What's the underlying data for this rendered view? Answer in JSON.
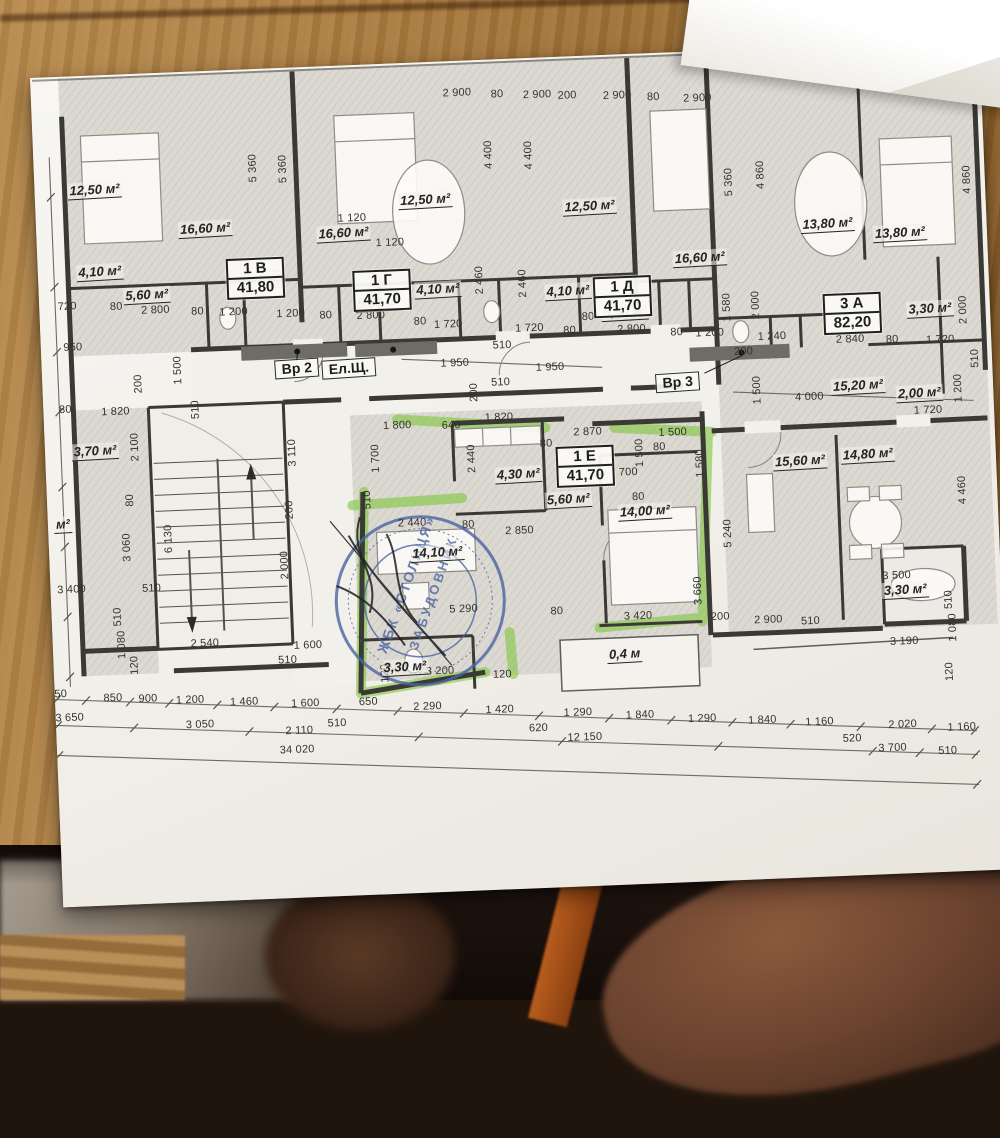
{
  "photo": {
    "scene": "floor plan sheet on wooden desk",
    "wood_color": "#aa7c41",
    "paper_color": "#f4f3ef",
    "shadow_color": "#120b07",
    "ink_color": "#34322d"
  },
  "plan": {
    "highlight_color": "#7fc63e",
    "stamp": {
      "line1": "ЖБК «СТОЛИЦЯ»",
      "line2": "ЗАБУДОВНИК",
      "color": "#4b63a5"
    },
    "units": [
      {
        "id": "1 В",
        "area": "41,80",
        "x": 217,
        "y": 209
      },
      {
        "id": "1 Г",
        "area": "41,70",
        "x": 343,
        "y": 226
      },
      {
        "id": "1 Д",
        "area": "41,70",
        "x": 583,
        "y": 242
      },
      {
        "id": "3 А",
        "area": "82,20",
        "x": 812,
        "y": 268
      },
      {
        "id": "1 Е",
        "area": "41,70",
        "x": 539,
        "y": 410
      }
    ],
    "doors": [
      {
        "t": "Вр 2",
        "x": 255,
        "y": 301
      },
      {
        "t": "Ел.Щ.",
        "x": 307,
        "y": 303
      },
      {
        "t": "Вр 3",
        "x": 635,
        "y": 330
      }
    ],
    "rooms": [
      {
        "t": "12,50 м²",
        "x": 60,
        "y": 115
      },
      {
        "t": "16,60 м²",
        "x": 169,
        "y": 158
      },
      {
        "t": "16,60 м²",
        "x": 307,
        "y": 168
      },
      {
        "t": "12,50 м²",
        "x": 390,
        "y": 138
      },
      {
        "t": "12,50 м²",
        "x": 554,
        "y": 151
      },
      {
        "t": "16,60 м²",
        "x": 662,
        "y": 207
      },
      {
        "t": "13,80 м²",
        "x": 791,
        "y": 178
      },
      {
        "t": "13,80 м²",
        "x": 863,
        "y": 190
      },
      {
        "t": "4,10 м²",
        "x": 62,
        "y": 197
      },
      {
        "t": "4,10 м²",
        "x": 399,
        "y": 228
      },
      {
        "t": "4,10 м²",
        "x": 529,
        "y": 235
      },
      {
        "t": "5,60 м²",
        "x": 108,
        "y": 222
      },
      {
        "t": "5,50 м²",
        "x": 339,
        "y": 239
      },
      {
        "t": "5,50 м²",
        "x": 585,
        "y": 258
      },
      {
        "t": "3,30 м²",
        "x": 890,
        "y": 267
      },
      {
        "t": "15,20 м²",
        "x": 815,
        "y": 341
      },
      {
        "t": "2,00 м²",
        "x": 876,
        "y": 351
      },
      {
        "t": "3,70 м²",
        "x": 50,
        "y": 376
      },
      {
        "t": "4,30 м²",
        "x": 472,
        "y": 416
      },
      {
        "t": "5,60 м²",
        "x": 521,
        "y": 443
      },
      {
        "t": "14,00 м²",
        "x": 597,
        "y": 458
      },
      {
        "t": "15,60 м²",
        "x": 754,
        "y": 414
      },
      {
        "t": "14,80 м²",
        "x": 822,
        "y": 410
      },
      {
        "t": "14,10 м²",
        "x": 388,
        "y": 491
      },
      {
        "t": "3,30 м²",
        "x": 351,
        "y": 604
      },
      {
        "t": "3,30 м²",
        "x": 854,
        "y": 547
      },
      {
        "t": "0,4 м",
        "x": 571,
        "y": 600
      },
      {
        "t": "м²",
        "x": 15,
        "y": 448
      }
    ],
    "dims": [
      {
        "t": "2 900",
        "x": 426,
        "y": 32
      },
      {
        "t": "80",
        "x": 466,
        "y": 35
      },
      {
        "t": "2 900",
        "x": 506,
        "y": 37
      },
      {
        "t": "200",
        "x": 536,
        "y": 39
      },
      {
        "t": "2 900",
        "x": 586,
        "y": 41
      },
      {
        "t": "80",
        "x": 622,
        "y": 44
      },
      {
        "t": "2 900",
        "x": 666,
        "y": 47
      },
      {
        "t": "5 360",
        "x": 219,
        "y": 99,
        "v": 1
      },
      {
        "t": "5 360",
        "x": 249,
        "y": 101,
        "v": 1
      },
      {
        "t": "4 400",
        "x": 455,
        "y": 95,
        "v": 1
      },
      {
        "t": "4 400",
        "x": 495,
        "y": 97,
        "v": 1
      },
      {
        "t": "5 360",
        "x": 694,
        "y": 132,
        "v": 1
      },
      {
        "t": "4 860",
        "x": 726,
        "y": 126,
        "v": 1
      },
      {
        "t": "4 860",
        "x": 932,
        "y": 139,
        "v": 1
      },
      {
        "t": "1 120",
        "x": 316,
        "y": 153
      },
      {
        "t": "1 120",
        "x": 353,
        "y": 179
      },
      {
        "t": "720",
        "x": 28,
        "y": 230
      },
      {
        "t": "80",
        "x": 77,
        "y": 232
      },
      {
        "t": "2 800",
        "x": 116,
        "y": 237
      },
      {
        "t": "80",
        "x": 158,
        "y": 240
      },
      {
        "t": "1 200",
        "x": 194,
        "y": 242
      },
      {
        "t": "1 580",
        "x": 210,
        "y": 214,
        "v": 1
      },
      {
        "t": "1 580",
        "x": 240,
        "y": 216,
        "v": 1
      },
      {
        "t": "1 200",
        "x": 251,
        "y": 246
      },
      {
        "t": "80",
        "x": 286,
        "y": 249
      },
      {
        "t": "2 800",
        "x": 331,
        "y": 251
      },
      {
        "t": "80",
        "x": 380,
        "y": 259
      },
      {
        "t": "1 720",
        "x": 408,
        "y": 263
      },
      {
        "t": "2 460",
        "x": 441,
        "y": 220,
        "v": 1
      },
      {
        "t": "2 460",
        "x": 484,
        "y": 225,
        "v": 1
      },
      {
        "t": "1 720",
        "x": 489,
        "y": 270
      },
      {
        "t": "80",
        "x": 529,
        "y": 274
      },
      {
        "t": "80",
        "x": 548,
        "y": 261
      },
      {
        "t": "2 800",
        "x": 591,
        "y": 275
      },
      {
        "t": "80",
        "x": 636,
        "y": 280
      },
      {
        "t": "1 200",
        "x": 669,
        "y": 282
      },
      {
        "t": "1 580",
        "x": 687,
        "y": 257,
        "v": 1
      },
      {
        "t": "2 000",
        "x": 716,
        "y": 256,
        "v": 1
      },
      {
        "t": "1 240",
        "x": 731,
        "y": 288
      },
      {
        "t": "2 840",
        "x": 809,
        "y": 294
      },
      {
        "t": "200",
        "x": 702,
        "y": 302
      },
      {
        "t": "80",
        "x": 851,
        "y": 296
      },
      {
        "t": "1 720",
        "x": 899,
        "y": 298
      },
      {
        "t": "2 000",
        "x": 923,
        "y": 269,
        "v": 1
      },
      {
        "t": "510",
        "x": 933,
        "y": 318,
        "v": 1
      },
      {
        "t": "1 200",
        "x": 915,
        "y": 347,
        "v": 1
      },
      {
        "t": "1 720",
        "x": 884,
        "y": 368
      },
      {
        "t": "4 000",
        "x": 766,
        "y": 350
      },
      {
        "t": "1 500",
        "x": 714,
        "y": 341,
        "v": 1
      },
      {
        "t": "4 460",
        "x": 915,
        "y": 449,
        "v": 1
      },
      {
        "t": "950",
        "x": 32,
        "y": 271
      },
      {
        "t": "1 500",
        "x": 136,
        "y": 298,
        "v": 1
      },
      {
        "t": "200",
        "x": 96,
        "y": 310,
        "v": 1
      },
      {
        "t": "80",
        "x": 22,
        "y": 333
      },
      {
        "t": "1 820",
        "x": 72,
        "y": 337
      },
      {
        "t": "510",
        "x": 152,
        "y": 338,
        "v": 1
      },
      {
        "t": "2 100",
        "x": 90,
        "y": 373,
        "v": 1
      },
      {
        "t": "510",
        "x": 461,
        "y": 286
      },
      {
        "t": "1 950",
        "x": 413,
        "y": 302
      },
      {
        "t": "1 950",
        "x": 508,
        "y": 310
      },
      {
        "t": "510",
        "x": 458,
        "y": 323
      },
      {
        "t": "200",
        "x": 431,
        "y": 332,
        "v": 1
      },
      {
        "t": "1 800",
        "x": 353,
        "y": 362
      },
      {
        "t": "640",
        "x": 407,
        "y": 364
      },
      {
        "t": "1 820",
        "x": 455,
        "y": 358
      },
      {
        "t": "2 870",
        "x": 543,
        "y": 376
      },
      {
        "t": "1 500",
        "x": 628,
        "y": 380
      },
      {
        "t": "1 700",
        "x": 330,
        "y": 394,
        "v": 1
      },
      {
        "t": "2 440",
        "x": 426,
        "y": 398,
        "v": 1
      },
      {
        "t": "80",
        "x": 501,
        "y": 386
      },
      {
        "t": "700",
        "x": 582,
        "y": 418
      },
      {
        "t": "1 500",
        "x": 594,
        "y": 399,
        "v": 1
      },
      {
        "t": "80",
        "x": 614,
        "y": 394
      },
      {
        "t": "1 580",
        "x": 654,
        "y": 412,
        "v": 1
      },
      {
        "t": "80",
        "x": 591,
        "y": 443
      },
      {
        "t": "2 440",
        "x": 364,
        "y": 460
      },
      {
        "t": "80",
        "x": 420,
        "y": 464
      },
      {
        "t": "2 850",
        "x": 471,
        "y": 472
      },
      {
        "t": "5 240",
        "x": 679,
        "y": 483,
        "v": 1
      },
      {
        "t": "3 660",
        "x": 647,
        "y": 539,
        "v": 1
      },
      {
        "t": "510",
        "x": 320,
        "y": 435,
        "v": 1
      },
      {
        "t": "5 290",
        "x": 412,
        "y": 548
      },
      {
        "t": "80",
        "x": 505,
        "y": 554
      },
      {
        "t": "3 200",
        "x": 386,
        "y": 609
      },
      {
        "t": "120",
        "x": 448,
        "y": 615
      },
      {
        "t": "120",
        "x": 331,
        "y": 609,
        "v": 1
      },
      {
        "t": "3 420",
        "x": 586,
        "y": 562
      },
      {
        "t": "200",
        "x": 668,
        "y": 566
      },
      {
        "t": "2 900",
        "x": 716,
        "y": 571
      },
      {
        "t": "510",
        "x": 758,
        "y": 574
      },
      {
        "t": "3 500",
        "x": 846,
        "y": 532
      },
      {
        "t": "3 190",
        "x": 851,
        "y": 598
      },
      {
        "t": "510",
        "x": 897,
        "y": 558,
        "v": 1
      },
      {
        "t": "1 080",
        "x": 900,
        "y": 586,
        "v": 1
      },
      {
        "t": "120",
        "x": 895,
        "y": 630,
        "v": 1
      },
      {
        "t": "3 400",
        "x": 21,
        "y": 513
      },
      {
        "t": "510",
        "x": 101,
        "y": 515
      },
      {
        "t": "510",
        "x": 66,
        "y": 542,
        "v": 1
      },
      {
        "t": "1 080",
        "x": 69,
        "y": 570,
        "v": 1
      },
      {
        "t": "120",
        "x": 81,
        "y": 591,
        "v": 1
      },
      {
        "t": "2 540",
        "x": 152,
        "y": 572
      },
      {
        "t": "1 600",
        "x": 255,
        "y": 578
      },
      {
        "t": "510",
        "x": 234,
        "y": 592
      },
      {
        "t": "2 000",
        "x": 235,
        "y": 497,
        "v": 1
      },
      {
        "t": "3 110",
        "x": 247,
        "y": 385,
        "v": 1
      },
      {
        "t": "200",
        "x": 242,
        "y": 442,
        "v": 1
      },
      {
        "t": "6 130",
        "x": 120,
        "y": 466,
        "v": 1
      },
      {
        "t": "80",
        "x": 83,
        "y": 426,
        "v": 1
      },
      {
        "t": "3 060",
        "x": 78,
        "y": 473,
        "v": 1
      },
      {
        "t": "50",
        "x": 6,
        "y": 617
      },
      {
        "t": "850",
        "x": 58,
        "y": 623
      },
      {
        "t": "900",
        "x": 93,
        "y": 625
      },
      {
        "t": "1 200",
        "x": 135,
        "y": 628
      },
      {
        "t": "1 460",
        "x": 189,
        "y": 632
      },
      {
        "t": "1 600",
        "x": 250,
        "y": 636
      },
      {
        "t": "650",
        "x": 313,
        "y": 637
      },
      {
        "t": "2 290",
        "x": 372,
        "y": 644
      },
      {
        "t": "1 420",
        "x": 444,
        "y": 650
      },
      {
        "t": "1 290",
        "x": 522,
        "y": 656
      },
      {
        "t": "1 840",
        "x": 584,
        "y": 661
      },
      {
        "t": "1 290",
        "x": 646,
        "y": 667
      },
      {
        "t": "1 840",
        "x": 706,
        "y": 671
      },
      {
        "t": "1 160",
        "x": 763,
        "y": 675
      },
      {
        "t": "2 020",
        "x": 846,
        "y": 681
      },
      {
        "t": "1 160",
        "x": 905,
        "y": 686
      },
      {
        "t": "3 650",
        "x": 14,
        "y": 641
      },
      {
        "t": "3 050",
        "x": 144,
        "y": 653
      },
      {
        "t": "2 110",
        "x": 243,
        "y": 663
      },
      {
        "t": "510",
        "x": 281,
        "y": 657
      },
      {
        "t": "620",
        "x": 482,
        "y": 670
      },
      {
        "t": "12 150",
        "x": 528,
        "y": 681
      },
      {
        "t": "520",
        "x": 795,
        "y": 693
      },
      {
        "t": "3 700",
        "x": 835,
        "y": 704
      },
      {
        "t": "510",
        "x": 890,
        "y": 709
      },
      {
        "t": "34 020",
        "x": 240,
        "y": 682
      }
    ]
  }
}
